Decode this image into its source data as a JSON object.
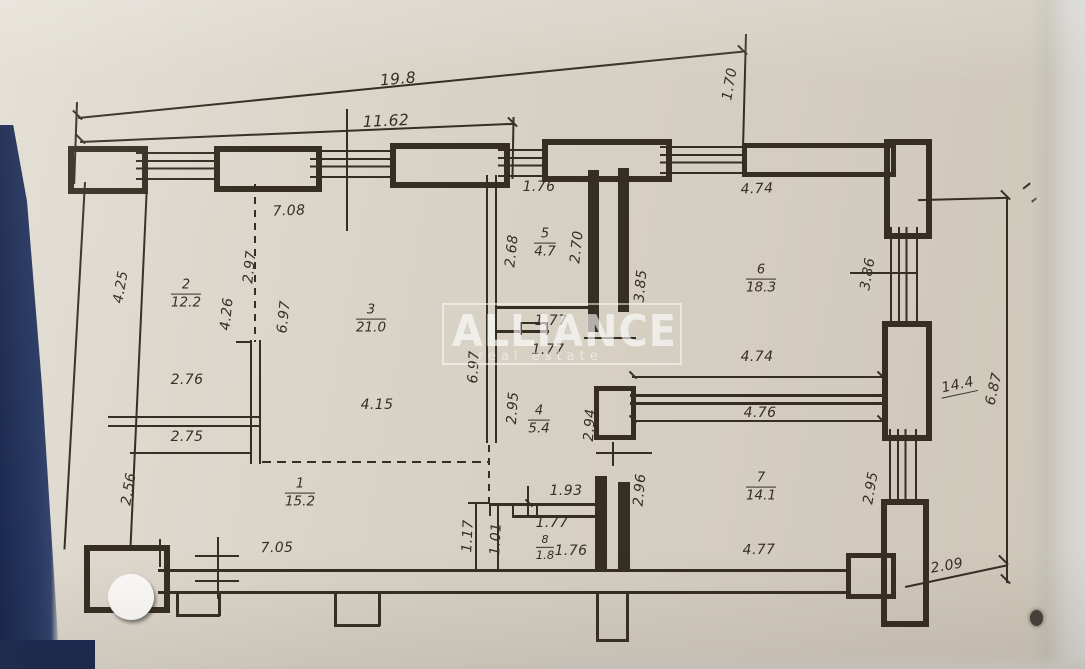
{
  "watermark": {
    "title": "ALLIANCE",
    "subtitle": "real estate"
  },
  "colors": {
    "paper": "#d8d2c6",
    "ink": "#372e23",
    "edge_blue": "#1d2c55",
    "edge_gray": "#d5d3cf",
    "watermark_white": "#ffffff"
  },
  "rooms": [
    {
      "number": "1",
      "area": "15.2"
    },
    {
      "number": "2",
      "area": "12.2"
    },
    {
      "number": "3",
      "area": "21.0"
    },
    {
      "number": "4",
      "area": "5.4"
    },
    {
      "number": "5",
      "area": "4.7"
    },
    {
      "number": "6",
      "area": "18.3"
    },
    {
      "number": "7",
      "area": "14.1"
    },
    {
      "number": "8",
      "area": "1.8"
    }
  ],
  "dims": {
    "top_total": "19.8",
    "top_partial": "11.62",
    "top_right_side": "1.70",
    "left_upper": "4.25",
    "left_lower": "2.56",
    "room2_top": "7.08",
    "room2_upper": "2.97",
    "room2_height": "4.26",
    "room2_width": "2.76",
    "room2_width_lower": "2.75",
    "room3_left": "6.97",
    "room3_right": "6.97",
    "room3_width": "4.15",
    "room5_top": "1.76",
    "room5_left": "2.68",
    "room5_right": "2.70",
    "hall_upper": "1.77",
    "hall_lower": "1.77",
    "room4_left": "2.95",
    "room4_right": "2.94",
    "room6_top": "4.74",
    "room6_left": "3.85",
    "room6_right": "3.86",
    "room6_bottom": "4.74",
    "room7_top": "4.76",
    "room7_left": "2.96",
    "room7_right": "2.95",
    "room7_bottom": "4.77",
    "room8_top": "1.93",
    "room8_mid": "1.77",
    "room8_width": "1.76",
    "room8_left_outer": "1.17",
    "room8_left_inner": "1.01",
    "room1_bottom": "7.05",
    "right_total": "14.4",
    "right_height": "6.87",
    "right_offset": "2.09"
  }
}
